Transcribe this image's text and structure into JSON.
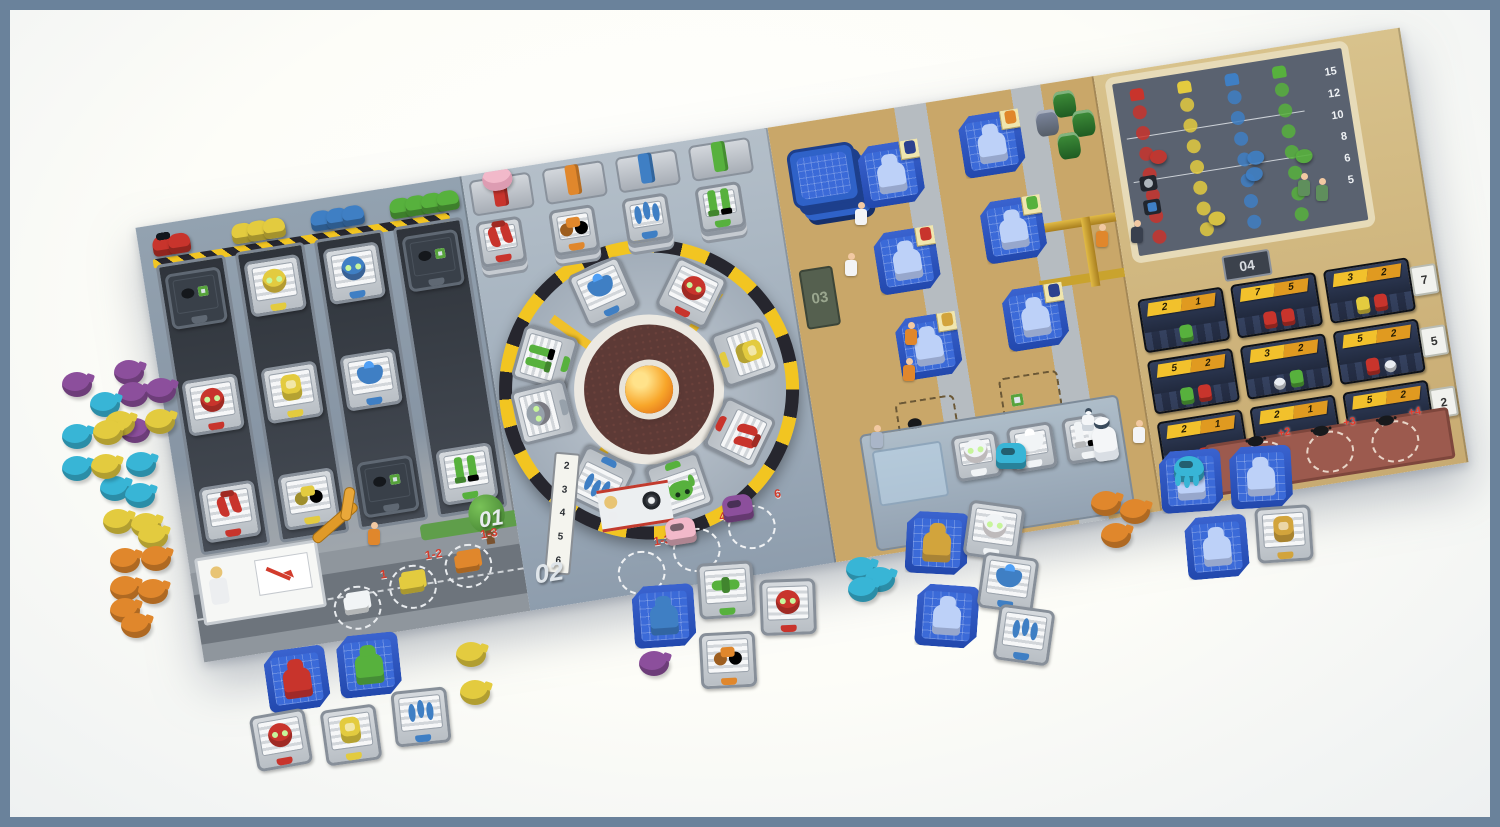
{
  "palette": {
    "frame": "#6a829b",
    "table": "#fcfcf6",
    "red": "#c8342c",
    "orange": "#e0872c",
    "yellow": "#e3cb3f",
    "green": "#57b13d",
    "blue": "#3f7fc4",
    "cyan": "#38b5d6",
    "purple": "#8c4f9c",
    "pink": "#f2b9ca",
    "gold": "#d2a43c",
    "navy": "#2c418f",
    "sketch": "#bdd1f8",
    "white": "#f1f4f6",
    "gray": "#97a1ab",
    "badge": "#e9edf2",
    "banner": "#f2c12c",
    "banner2": "#e09a20",
    "maroon": "#9c5a4e",
    "tan": "#c9a769"
  },
  "sections": {
    "warehouse": {
      "id_label": "01",
      "columns": [
        {
          "color": "red",
          "meeple_list": [
            "red",
            "red"
          ],
          "tiles": [
            {
              "part": "slot",
              "color": "gray"
            },
            {
              "part": "head",
              "color": "red"
            },
            {
              "part": "claws",
              "color": "red"
            }
          ]
        },
        {
          "color": "yellow",
          "meeple_list": [
            "yellow",
            "yellow",
            "yellow"
          ],
          "tiles": [
            {
              "part": "head",
              "color": "yellow"
            },
            {
              "part": "body",
              "color": "yellow"
            },
            {
              "part": "wheels",
              "color": "yellow"
            }
          ]
        },
        {
          "color": "blue",
          "meeple_list": [
            "blue",
            "blue",
            "blue"
          ],
          "tiles": [
            {
              "part": "head",
              "color": "blue"
            },
            {
              "part": "chest",
              "color": "blue"
            },
            {
              "part": "slot",
              "color": "gray"
            }
          ]
        },
        {
          "color": "green",
          "meeple_list": [
            "green",
            "green",
            "green",
            "green"
          ],
          "tiles": [
            {
              "part": "slot",
              "color": "gray"
            },
            {
              "part": "empty",
              "color": "gray"
            },
            {
              "part": "legs",
              "color": "green"
            }
          ]
        }
      ],
      "street_slots": [
        {
          "label": "1",
          "cargo": "white",
          "style": "left:136px;top:388px"
        },
        {
          "label": "1-2",
          "cargo": "yellow",
          "style": "left:194px;top:376px"
        },
        {
          "label": "1-3",
          "cargo": "orange",
          "style": "left:252px;top:364px"
        }
      ]
    },
    "assembly": {
      "id_label": "02",
      "supply_stacks": [
        {
          "color": "red",
          "part": "claws"
        },
        {
          "color": "orange",
          "part": "wheels"
        },
        {
          "color": "blue",
          "part": "spiders"
        },
        {
          "color": "green",
          "part": "legs"
        }
      ],
      "wheel_tiles": [
        {
          "part": "legs",
          "color": "green",
          "style": "left:26px;top:165px;--rot:-65deg"
        },
        {
          "part": "chest",
          "color": "blue",
          "style": "left:94px;top:108px;--rot:-15deg"
        },
        {
          "part": "head",
          "color": "red",
          "style": "left:181px;top:123px;--rot:35deg"
        },
        {
          "part": "body",
          "color": "yellow",
          "style": "left:224px;top:191px;--rot:80deg"
        },
        {
          "part": "claws",
          "color": "red",
          "style": "left:207px;top:269px;--rot:125deg"
        },
        {
          "part": "frog",
          "color": "green",
          "style": "left:139px;top:312px;--rot:170deg"
        },
        {
          "part": "spiders",
          "color": "blue",
          "style": "left:61px;top:295px;--rot:-145deg"
        },
        {
          "part": "head",
          "color": "gray",
          "style": "left:16px;top:218px;--rot:-95deg"
        }
      ],
      "speed_track": [
        {
          "label": "2"
        },
        {
          "label": "3"
        },
        {
          "label": "4"
        },
        {
          "label": "5"
        },
        {
          "label": "6"
        }
      ],
      "wheel_slots": [
        {
          "label": "1-3",
          "style": "left:92px;top:398px"
        },
        {
          "label": "4",
          "style": "left:150px;top:384px"
        },
        {
          "label": "6",
          "style": "left:208px;top:370px"
        }
      ],
      "meeples": [
        {
          "color": "pink",
          "style": "left:146px;top:372px"
        },
        {
          "color": "purple",
          "style": "left:206px;top: 358px"
        }
      ]
    },
    "design": {
      "id_label": "03",
      "blueprints": [
        {
          "color": "sketch",
          "sticker": "navy",
          "style": "left:84px;top:34px"
        },
        {
          "color": "sketch",
          "sticker": "red",
          "style": "left:86px;top:122px"
        },
        {
          "color": "sketch",
          "sticker": "gold",
          "style": "left:94px;top:210px"
        },
        {
          "color": "sketch",
          "sticker": "orange",
          "style": "left:188px;top:20px"
        },
        {
          "color": "sketch",
          "sticker": "green",
          "style": "left:196px;top:108px"
        },
        {
          "color": "sketch",
          "sticker": "navy",
          "style": "left:204px;top:198px"
        }
      ],
      "test_tiles": [
        {
          "part": "head",
          "color": "white",
          "tab": "pink"
        },
        {
          "part": "chest",
          "color": "white",
          "tab": "pink"
        },
        {
          "part": "legs",
          "color": "white",
          "tab": "pink"
        }
      ]
    },
    "market": {
      "id_label": "04",
      "tracks": [
        {
          "color": "red"
        },
        {
          "color": "yellow"
        },
        {
          "color": "blue"
        },
        {
          "color": "green"
        }
      ],
      "score_scale": [
        {
          "label": "15"
        },
        {
          "label": "12"
        },
        {
          "label": "10"
        },
        {
          "label": "8"
        },
        {
          "label": "6"
        },
        {
          "label": "5"
        }
      ],
      "markers": [
        {
          "color": "red",
          "style": "left:26px;top:72px"
        },
        {
          "color": "yellow",
          "style": "left:74px;top:142px"
        },
        {
          "color": "blue",
          "style": "left:122px;top:88px"
        },
        {
          "color": "blue",
          "style": "left:118px;top:104px"
        },
        {
          "color": "green",
          "style": "left:170px;top:94px"
        }
      ],
      "order_cards": [
        {
          "a": "2",
          "b": "1",
          "robots": [
            "green"
          ]
        },
        {
          "a": "7",
          "b": "5",
          "robots": [
            "red",
            "red"
          ]
        },
        {
          "a": "3",
          "b": "2",
          "robots": [
            "yellow",
            "red"
          ]
        },
        {
          "a": "5",
          "b": "2",
          "robots": [
            "green",
            "red"
          ]
        },
        {
          "a": "3",
          "b": "2",
          "robots": [
            "badge",
            "green"
          ]
        },
        {
          "a": "5",
          "b": "2",
          "robots": [
            "red",
            "badge"
          ]
        },
        {
          "a": "2",
          "b": "1",
          "robots": [
            "red"
          ]
        },
        {
          "a": "2",
          "b": "1",
          "robots": [
            "yellow"
          ]
        },
        {
          "a": "5",
          "b": "2",
          "robots": [
            "yellow",
            "green"
          ]
        }
      ],
      "row_bonuses": [
        {
          "label": "7"
        },
        {
          "label": "5"
        },
        {
          "label": "2"
        }
      ],
      "penalty_slots": [
        {
          "label": "+2"
        },
        {
          "label": "+3"
        },
        {
          "label": "+4"
        }
      ]
    }
  },
  "pieces": {
    "discs": [
      {
        "color": "purple",
        "style": "left:52px;top:362px"
      },
      {
        "color": "purple",
        "style": "left:104px;top:350px"
      },
      {
        "color": "purple",
        "style": "left:108px;top:372px"
      },
      {
        "color": "purple",
        "style": "left:136px;top:368px"
      },
      {
        "color": "purple",
        "style": "left:110px;top:408px"
      },
      {
        "color": "cyan",
        "style": "left:80px;top:382px"
      },
      {
        "color": "cyan",
        "style": "left:52px;top:414px"
      },
      {
        "color": "cyan",
        "style": "left:52px;top:446px"
      },
      {
        "color": "cyan",
        "style": "left:116px;top:442px"
      },
      {
        "color": "cyan",
        "style": "left:90px;top:466px"
      },
      {
        "color": "cyan",
        "style": "left:115px;top:473px"
      },
      {
        "color": "yellow",
        "style": "left:95px;top:401px"
      },
      {
        "color": "yellow",
        "style": "left:135px;top:399px"
      },
      {
        "color": "yellow",
        "style": "left:83px;top:410px"
      },
      {
        "color": "yellow",
        "style": "left:81px;top:444px"
      },
      {
        "color": "yellow",
        "style": "left:93px;top:499px"
      },
      {
        "color": "yellow",
        "style": "left:121px;top:503px"
      },
      {
        "color": "yellow",
        "style": "left:128px;top:514px"
      },
      {
        "color": "orange",
        "style": "left:100px;top:538px"
      },
      {
        "color": "orange",
        "style": "left:131px;top:536px"
      },
      {
        "color": "orange",
        "style": "left:100px;top:566px"
      },
      {
        "color": "orange",
        "style": "left:128px;top:569px"
      },
      {
        "color": "orange",
        "style": "left:100px;top:588px"
      },
      {
        "color": "orange",
        "style": "left:111px;top:603px"
      },
      {
        "color": "yellow",
        "style": "left:446px;top:632px"
      },
      {
        "color": "yellow",
        "style": "left:450px;top:670px"
      },
      {
        "color": "purple",
        "style": "left:629px;top:641px"
      },
      {
        "color": "cyan",
        "style": "left:836px;top:547px"
      },
      {
        "color": "cyan",
        "style": "left:855px;top:557px"
      },
      {
        "color": "cyan",
        "style": "left:838px;top:567px"
      },
      {
        "color": "orange",
        "style": "left:1081px;top:481px"
      },
      {
        "color": "orange",
        "style": "left:1110px;top:489px"
      },
      {
        "color": "orange",
        "style": "left:1091px;top:513px"
      }
    ],
    "scatter_tiles": [
      {
        "kind": "bp",
        "color": "red",
        "sticker": "orange",
        "style": "left:256px;top:638px;--rot:-8deg"
      },
      {
        "kind": "bp",
        "color": "green",
        "sticker": "green",
        "style": "left:328px;top:624px;--rot:-6deg"
      },
      {
        "kind": "part",
        "part": "head",
        "color": "red",
        "style": "left:243px;top:702px;--rot:-10deg"
      },
      {
        "kind": "part",
        "part": "body",
        "color": "yellow",
        "style": "left:313px;top:697px;--rot:-8deg"
      },
      {
        "kind": "part",
        "part": "spiders",
        "color": "blue",
        "style": "left:383px;top:679px;--rot:-6deg"
      },
      {
        "kind": "bp",
        "color": "blue",
        "sticker": "navy",
        "style": "left:623px;top:575px;--rot:-4deg"
      },
      {
        "kind": "part",
        "part": "shoulders",
        "color": "green",
        "style": "left:688px;top:552px;--rot:-4deg"
      },
      {
        "kind": "part",
        "part": "head",
        "color": "red",
        "style": "left:750px;top:569px;--rot:-2deg"
      },
      {
        "kind": "part",
        "part": "wheels",
        "color": "orange",
        "style": "left:690px;top:622px;--rot:-3deg"
      },
      {
        "kind": "bp",
        "color": "gold",
        "sticker": "gold",
        "style": "left:896px;top:502px;--rot:3deg"
      },
      {
        "kind": "bp",
        "color": "sketch",
        "sticker": "navy",
        "style": "left:906px;top:575px;--rot:4deg"
      },
      {
        "kind": "part",
        "part": "head",
        "color": "white",
        "style": "left:956px;top:493px;--rot:8deg"
      },
      {
        "kind": "part",
        "part": "chest",
        "color": "blue",
        "style": "left:970px;top:545px;--rot:8deg"
      },
      {
        "kind": "part",
        "part": "spiders",
        "color": "blue",
        "style": "left:986px;top:597px;--rot:8deg"
      },
      {
        "kind": "bp",
        "color": "sketch",
        "sticker": "navy",
        "style": "left:1150px;top:440px;--rot:-4deg"
      },
      {
        "kind": "bp",
        "color": "sketch",
        "sticker": "gold",
        "style": "left:1220px;top:436px;--rot:-3deg"
      },
      {
        "kind": "bp",
        "color": "sketch",
        "sticker": "red",
        "style": "left:1176px;top:506px;--rot:-5deg"
      },
      {
        "kind": "part",
        "part": "body",
        "color": "gold",
        "style": "left:1246px;top:496px;--rot:-4deg"
      }
    ],
    "meeples": [
      {
        "color": "cyan",
        "kind": "robot",
        "style": "left:986px;top:433px"
      },
      {
        "color": "cyan",
        "kind": "spider",
        "style": "left:1164px;top:446px"
      }
    ],
    "figures": [
      {
        "variant": "worker",
        "style": "left:358px;top:512px"
      },
      {
        "variant": "scientist",
        "style": "left:845px;top:192px"
      },
      {
        "variant": "scientist",
        "style": "left:835px;top:243px"
      },
      {
        "variant": "worker",
        "style": "left:895px;top:312px"
      },
      {
        "variant": "worker",
        "style": "left:893px;top:348px"
      },
      {
        "variant": "woman",
        "style": "left:861px;top:415px"
      },
      {
        "variant": "scientist",
        "style": "left:1123px;top:410px"
      },
      {
        "variant": "robot",
        "style": "left:1072px;top:398px"
      },
      {
        "variant": "worker",
        "style": "left:1086px;top:214px"
      },
      {
        "variant": "suit",
        "style": "left:1121px;top:210px"
      },
      {
        "variant": "kid",
        "style": "left:1288px;top:163px"
      },
      {
        "variant": "kid",
        "style": "left:1306px;top:168px"
      }
    ]
  }
}
